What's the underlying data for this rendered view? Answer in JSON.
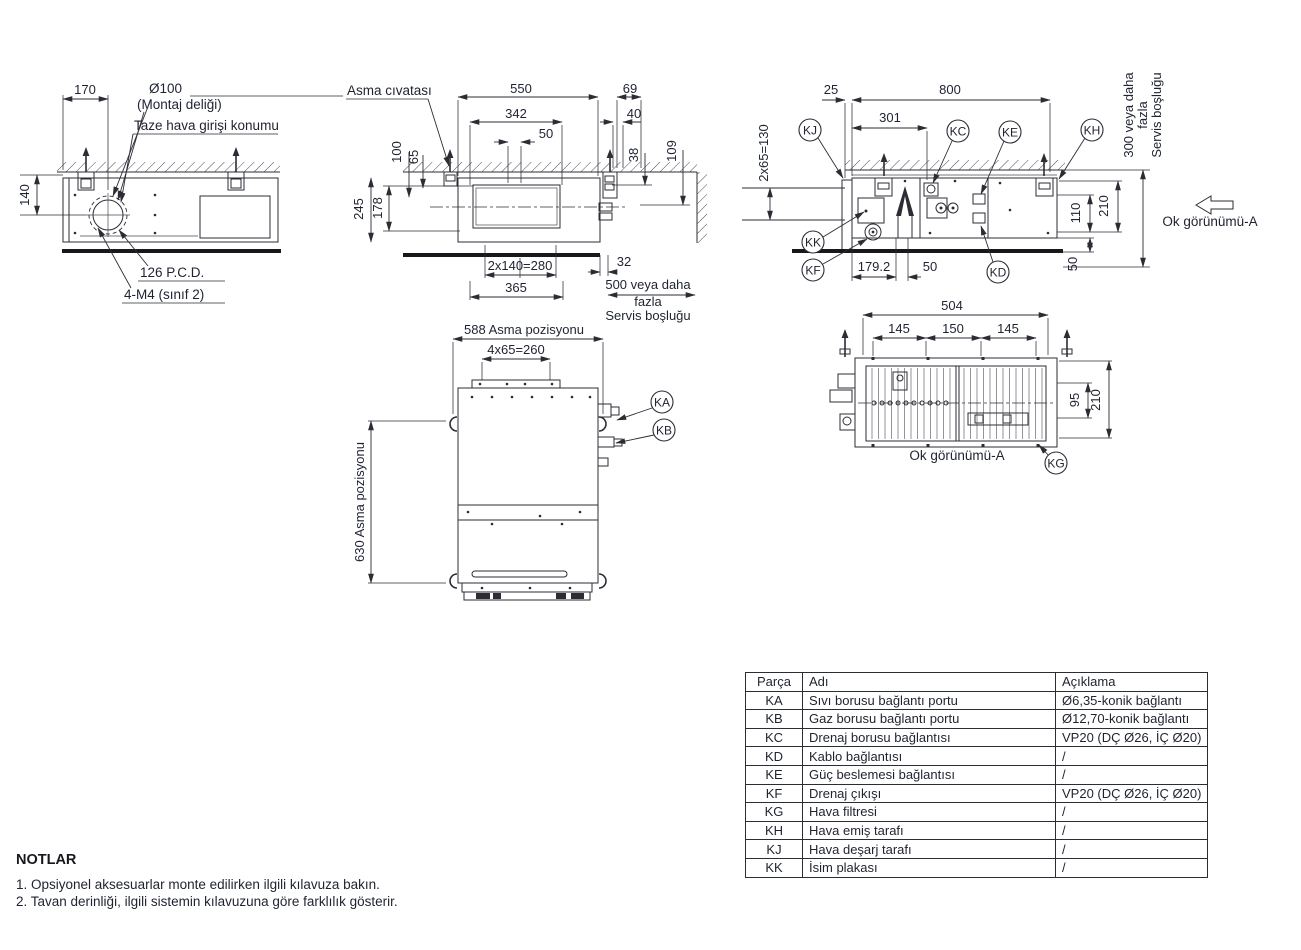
{
  "side_view": {
    "dim_width": "170",
    "dim_height": "140",
    "hole_dia": "Ø100",
    "hole_label": "(Montaj deliği)",
    "fresh_air_label": "Taze hava girişi konumu",
    "pcd_label": "126 P.C.D.",
    "screw_label": "4-M4 (sınıf 2)"
  },
  "front_view": {
    "hanger_label": "Asma cıvatası",
    "dim_550": "550",
    "dim_69": "69",
    "dim_342": "342",
    "dim_50": "50",
    "dim_40": "40",
    "dim_100": "100",
    "dim_65": "65",
    "dim_38": "38",
    "dim_109": "109",
    "dim_245": "245",
    "dim_178": "178",
    "dim_280": "2x140=280",
    "dim_365": "365",
    "dim_32": "32",
    "service_line1": "500 veya daha",
    "service_line2": "fazla",
    "service_line3": "Servis boşluğu"
  },
  "right_view": {
    "dim_25": "25",
    "dim_800": "800",
    "dim_301": "301",
    "dim_130": "2x65=130",
    "dim_179": "179.2",
    "dim_50": "50",
    "dim_110": "110",
    "dim_210": "210",
    "dim_50_floor": "50",
    "service_line1": "300 veya daha",
    "service_line2": "fazla",
    "service_line3": "Servis boşluğu",
    "view_arrow_label": "Ok görünümü-A"
  },
  "plan_view": {
    "dim_hang_width": "588 Asma pozisyonu",
    "dim_260": "4x65=260",
    "dim_hang_height": "630 Asma pozisyonu"
  },
  "bottom_view": {
    "dim_504": "504",
    "dim_145a": "145",
    "dim_150": "150",
    "dim_145b": "145",
    "dim_95": "95",
    "dim_210": "210",
    "view_arrow_label": "Ok görünümü-A"
  },
  "callouts": {
    "ka": "KA",
    "kb": "KB",
    "kc": "KC",
    "kd": "KD",
    "ke": "KE",
    "kf": "KF",
    "kg": "KG",
    "kh": "KH",
    "kj": "KJ",
    "kk": "KK"
  },
  "parts_table": {
    "col_part": "Parça",
    "col_name": "Adı",
    "col_desc": "Açıklama",
    "rows": [
      {
        "part": "KA",
        "name": "Sıvı borusu bağlantı portu",
        "desc": "Ø6,35-konik bağlantı"
      },
      {
        "part": "KB",
        "name": "Gaz borusu bağlantı portu",
        "desc": "Ø12,70-konik bağlantı"
      },
      {
        "part": "KC",
        "name": "Drenaj borusu bağlantısı",
        "desc": "VP20 (DÇ Ø26, İÇ Ø20)"
      },
      {
        "part": "KD",
        "name": "Kablo bağlantısı",
        "desc": "/"
      },
      {
        "part": "KE",
        "name": "Güç beslemesi bağlantısı",
        "desc": "/"
      },
      {
        "part": "KF",
        "name": "Drenaj çıkışı",
        "desc": "VP20 (DÇ Ø26, İÇ Ø20)"
      },
      {
        "part": "KG",
        "name": "Hava filtresi",
        "desc": "/"
      },
      {
        "part": "KH",
        "name": "Hava emiş tarafı",
        "desc": "/"
      },
      {
        "part": "KJ",
        "name": "Hava deşarj tarafı",
        "desc": "/"
      },
      {
        "part": "KK",
        "name": "İsim plakası",
        "desc": "/"
      }
    ]
  },
  "notes": {
    "title": "NOTLAR",
    "note1": "1. Opsiyonel aksesuarlar monte edilirken ilgili kılavuza bakın.",
    "note2": "2. Tavan derinliği, ilgili sistemin kılavuzuna göre farklılık gösterir."
  },
  "colors": {
    "line": "#2c2c34",
    "text": "#1f2330",
    "thick": "#17171c"
  }
}
